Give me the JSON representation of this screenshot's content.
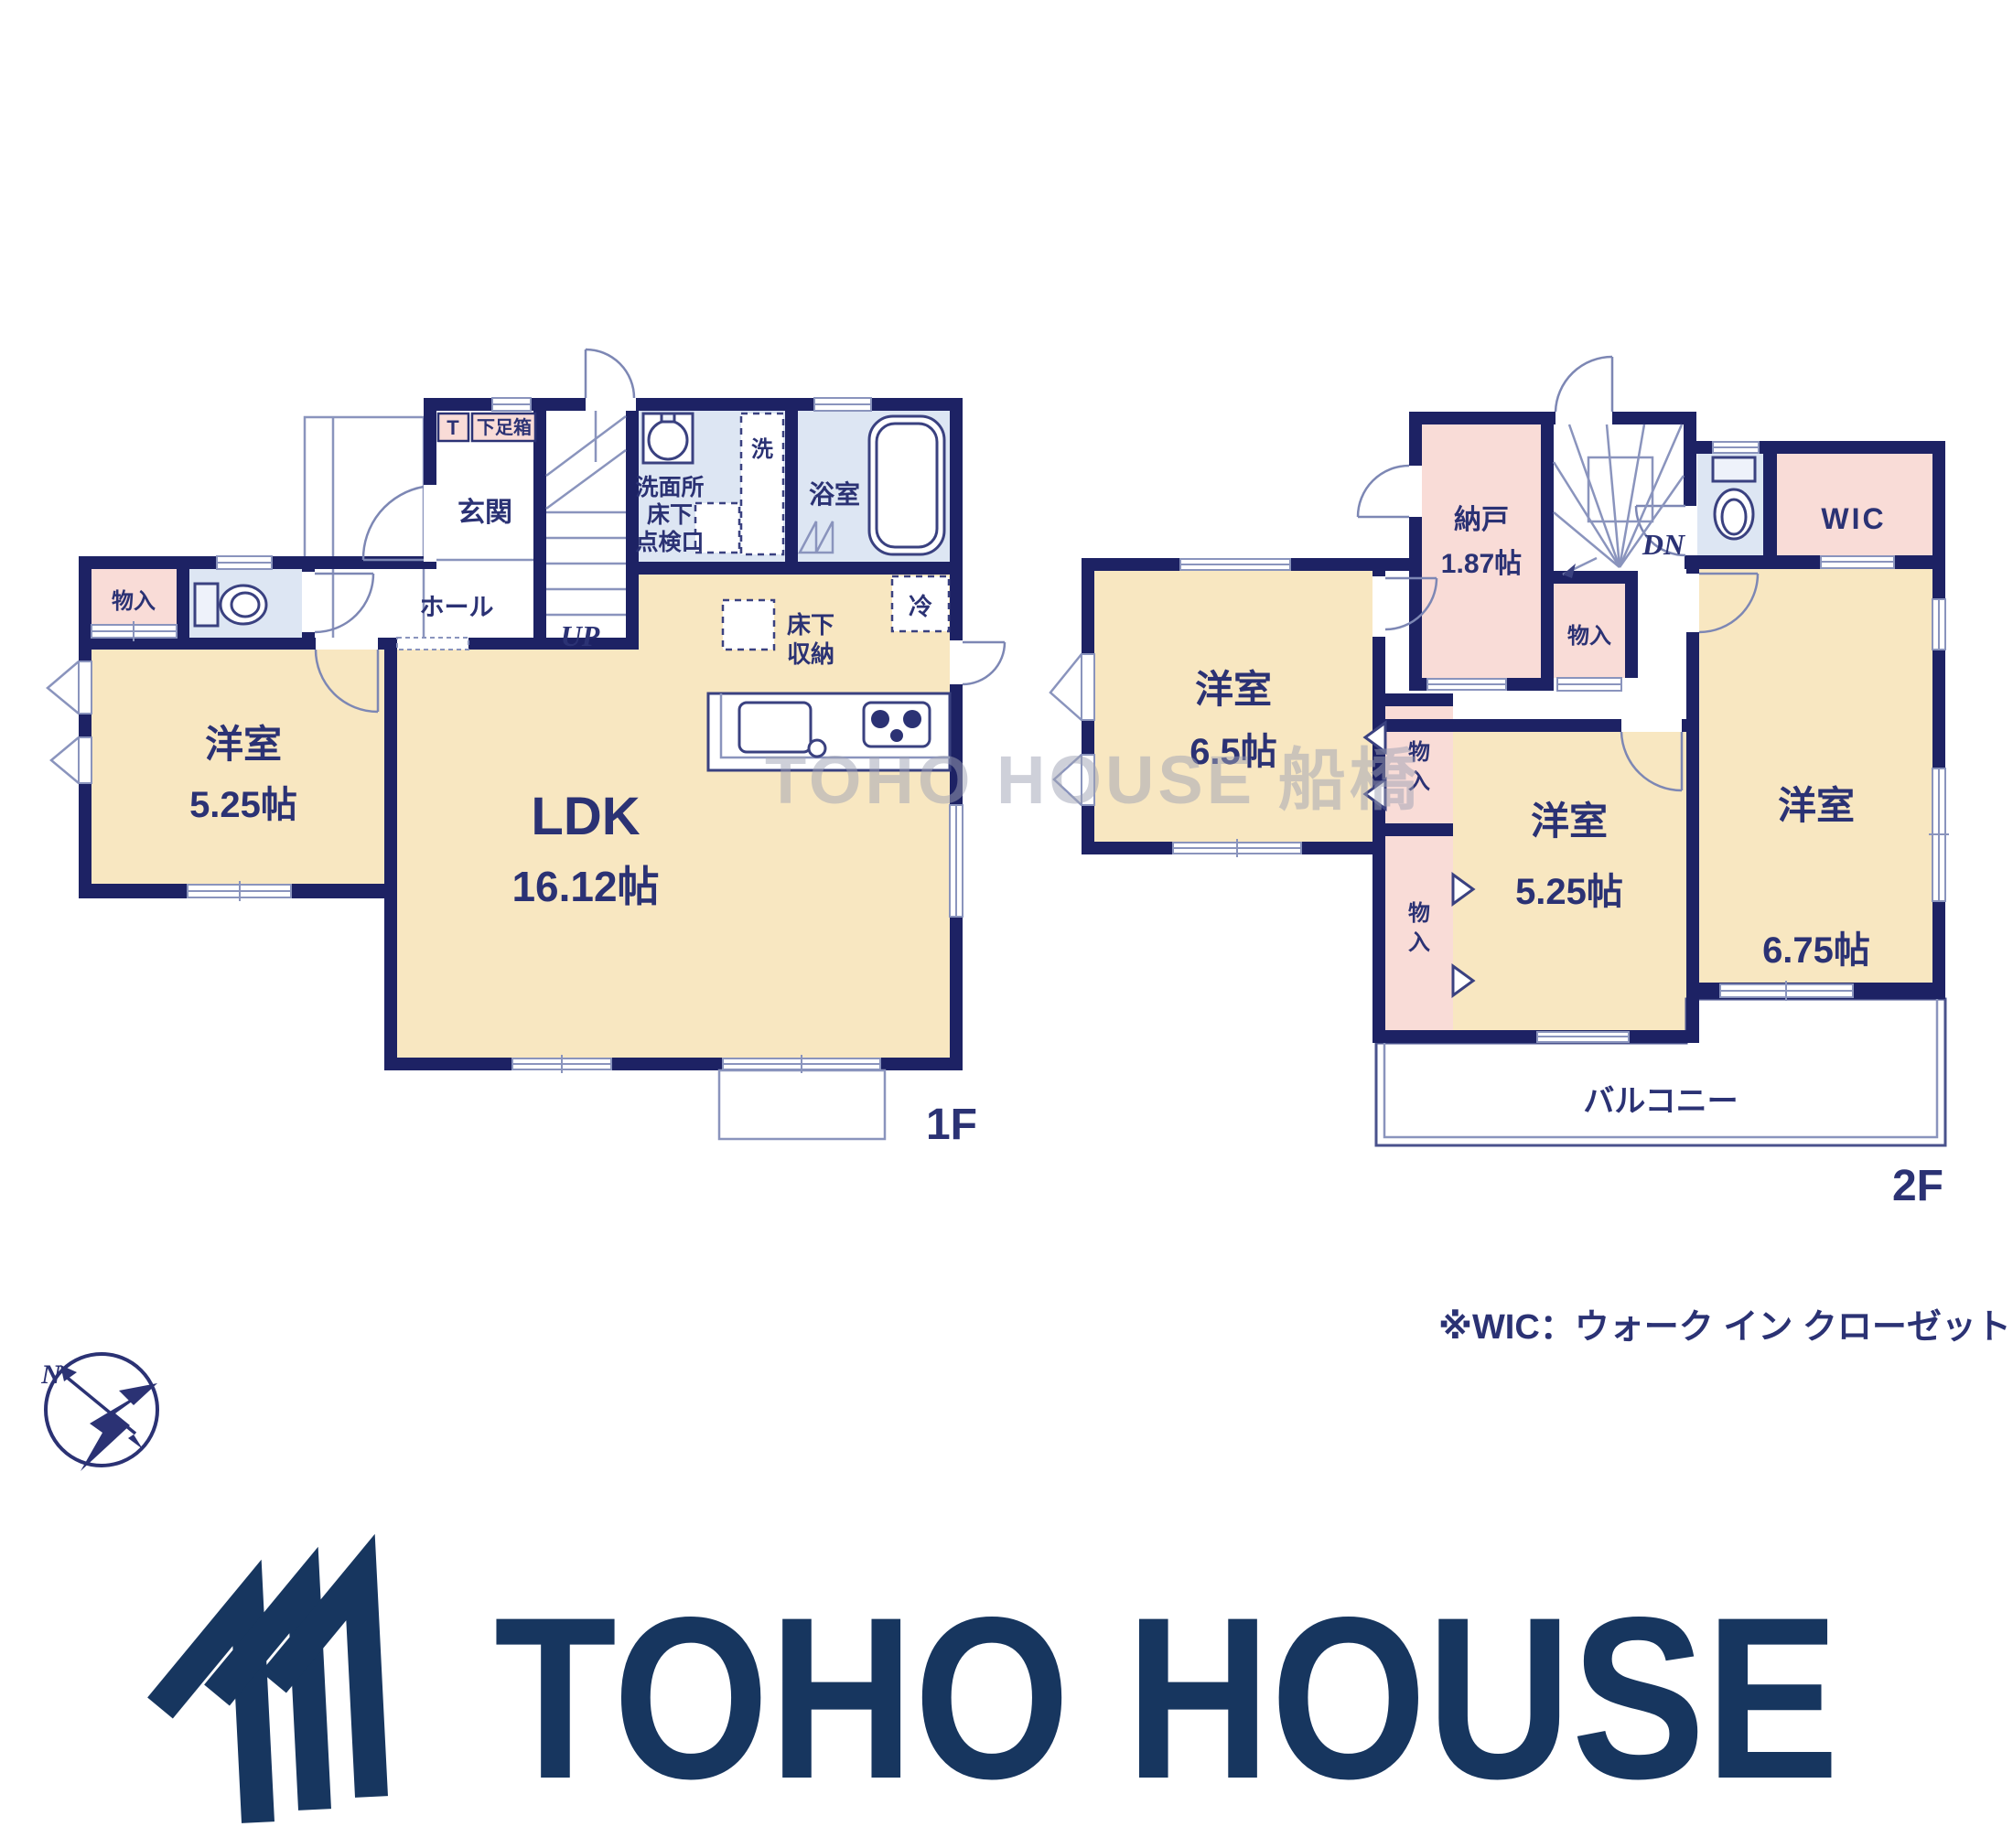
{
  "colors": {
    "wall_navy": "#1d2264",
    "room_cream": "#f8e7c1",
    "closet_pink": "#f9dcd7",
    "wet_area_blue": "#dde6f3",
    "label_navy": "#2b3274",
    "logo_navy": "#17365f",
    "watermark_gray": "#9fa2b4"
  },
  "floor1": {
    "floor_label": "1F",
    "genkan": "玄関",
    "shoebox_t": "T",
    "shoebox": "下足箱",
    "hall": "ホール",
    "stairs_up": "UP",
    "washroom_line1": "洗面所",
    "washroom_line2": "床下",
    "washroom_line3": "点検口",
    "laundry": "洗",
    "bath": "浴室",
    "refrigerator": "冷",
    "underfloor_line1": "床下",
    "underfloor_line2": "収納",
    "storage": "物入",
    "western_room": {
      "name": "洋室",
      "size": "5.25帖"
    },
    "ldk": {
      "name": "LDK",
      "size": "16.12帖"
    }
  },
  "floor2": {
    "floor_label": "2F",
    "storeroom": {
      "name": "納戸",
      "size": "1.87帖"
    },
    "stairs_down": "DN",
    "closet_hall": "物入",
    "wic": "WIC",
    "western_room_65": {
      "name": "洋室",
      "size": "6.5帖"
    },
    "western_room_525": {
      "name": "洋室",
      "size": "5.25帖"
    },
    "western_room_675": {
      "name": "洋室",
      "size": "6.75帖"
    },
    "closet_upper": {
      "line1": "物",
      "line2": "入"
    },
    "closet_lower": {
      "line1": "物",
      "line2": "入"
    },
    "balcony": "バルコニー"
  },
  "note": "※WIC：ウォーク イン クローゼット",
  "watermark": "TOHO HOUSE 船橋",
  "compass": {
    "north_label": "N"
  },
  "logo": {
    "brand_text": "TOHO HOUSE"
  }
}
